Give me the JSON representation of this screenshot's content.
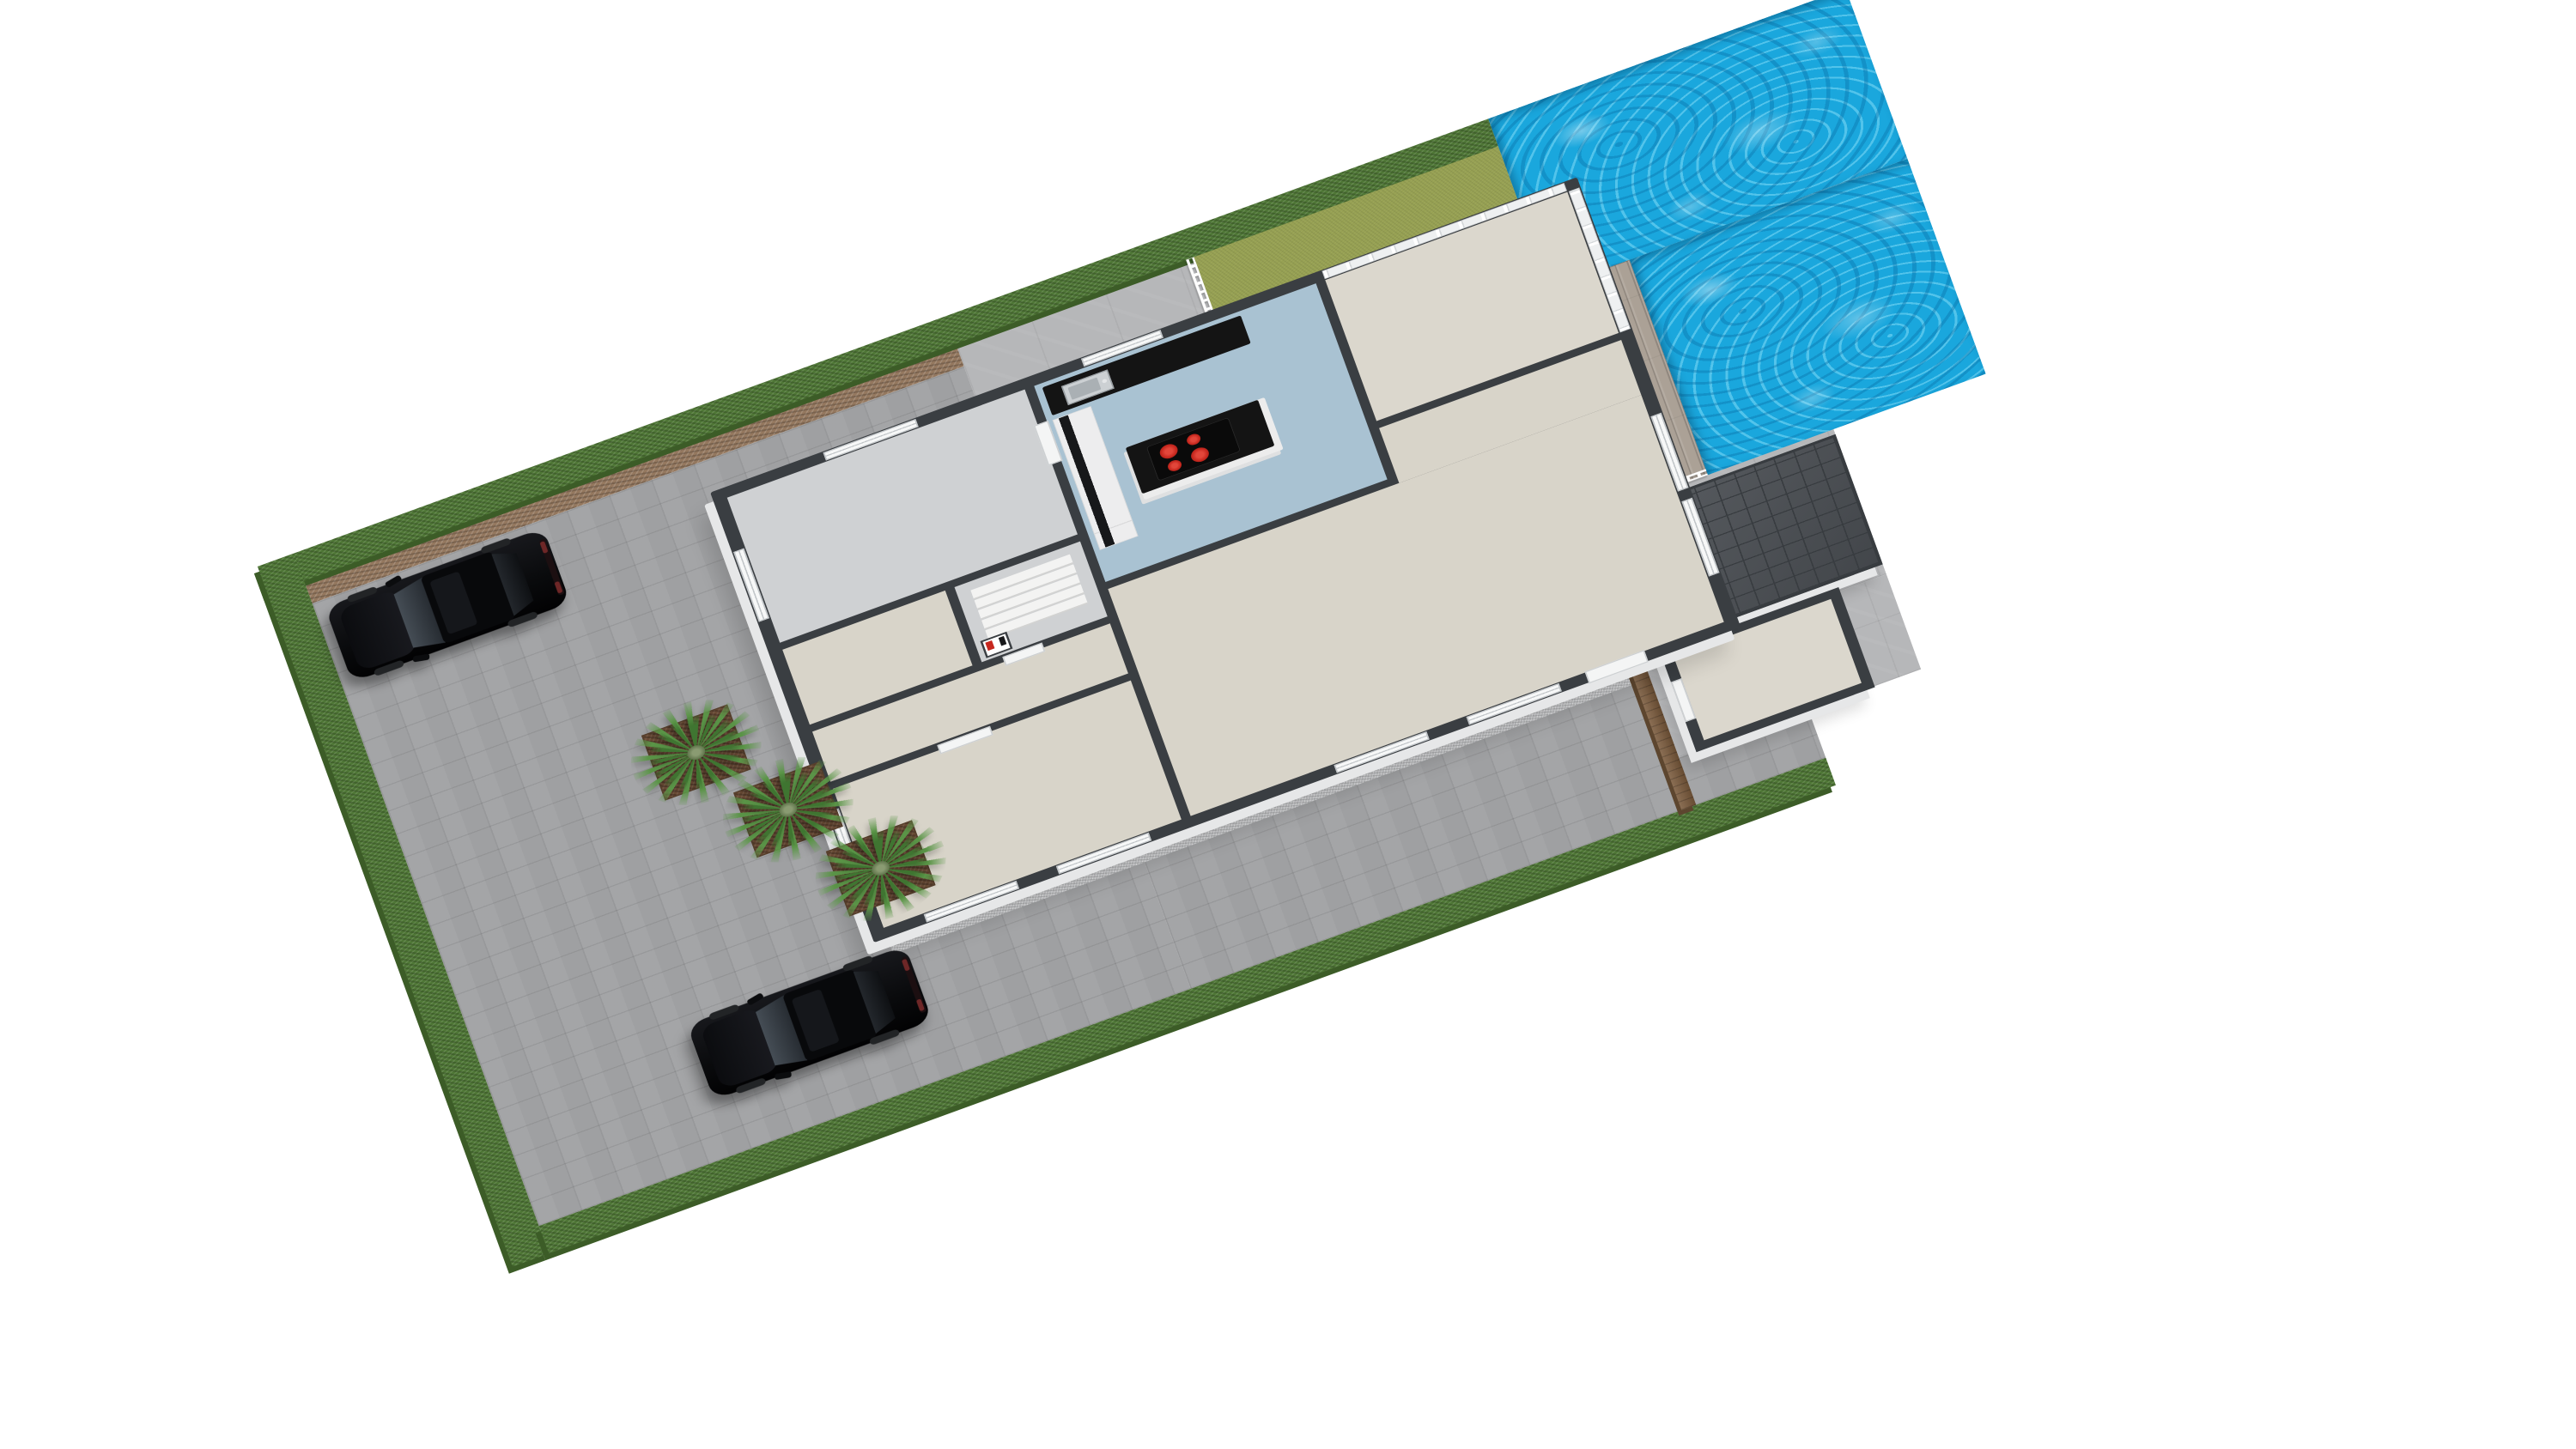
{
  "scene": {
    "type": "3d-floor-plan-render",
    "view": "isometric-dollhouse-cutaway",
    "background": "#ffffff",
    "visible_text": ""
  },
  "palette": {
    "wall_dark": "#3a3e42",
    "wall_white": "#e6e7e8",
    "floor_beige": "#d8d4c9",
    "floor_blue": "#a9c2d2",
    "floor_gray": "#cfd1d3",
    "floor_light": "#dbd7cd",
    "patio": "#b6b7b9",
    "pavers": "#9fa0a2",
    "gravel": "#c7c8ca",
    "hedge": "#4f7736",
    "hedge_shadow": "#3c5c27",
    "lawn": "#97a153",
    "mulch": "#94785f",
    "pool": "#1aa7dd",
    "deck": "#aba196",
    "railing": "#ffffff",
    "roof": "#4c5055",
    "roof_line": "#383c40",
    "counter_black": "#141414",
    "burner_red": "#c6271e",
    "soil": "#6b4c36",
    "palm_green": "#5a9447",
    "palm_green_dark": "#3f7531",
    "wood_fence": "#7a5a3c",
    "wood_fence_dark": "#5d462f",
    "car_black": "#0a0b0d"
  },
  "property": {
    "grounds": {
      "driveway_material": "grey block pavers",
      "patio_material": "large grey tiles",
      "perimeter": "green hedge with brown mulch strip",
      "gravel_strips": "along house facade"
    },
    "house": {
      "style": "single-storey cutaway with dark wall tops",
      "rooms": [
        {
          "name": "garage",
          "floor": "floor_gray"
        },
        {
          "name": "kitchen",
          "floor": "floor_blue"
        },
        {
          "name": "sunroom",
          "floor": "floor_light",
          "glazing": "full-height windows"
        },
        {
          "name": "living-room",
          "floor": "floor_beige"
        },
        {
          "name": "hallway",
          "floor": "floor_beige"
        },
        {
          "name": "stair-core",
          "floor": "floor_gray",
          "stair_treads": 5
        },
        {
          "name": "bedroom",
          "floor": "floor_beige"
        }
      ],
      "kitchen_fixtures": {
        "island_cooktop_burners": 4,
        "counter_color": "counter_black",
        "sink": "stainless with faucet",
        "tall_units": "white with black appliance slots"
      },
      "front_door": "white panel door with glass pane"
    },
    "outbuilding": {
      "name": "annex-storage",
      "roof": "dark grey tiled flat-pitch roof",
      "door": "white side door"
    },
    "pool": {
      "shape": "L-wrap around deck",
      "water": "bright blue with caustics"
    },
    "deck": {
      "material": "weathered wood planks",
      "railing": "white baluster fence"
    },
    "vehicles": {
      "count": 2,
      "type": "black SUV",
      "color": "car_black"
    },
    "landscaping": {
      "palm_planters": 3,
      "lawn_patches": 1
    }
  }
}
